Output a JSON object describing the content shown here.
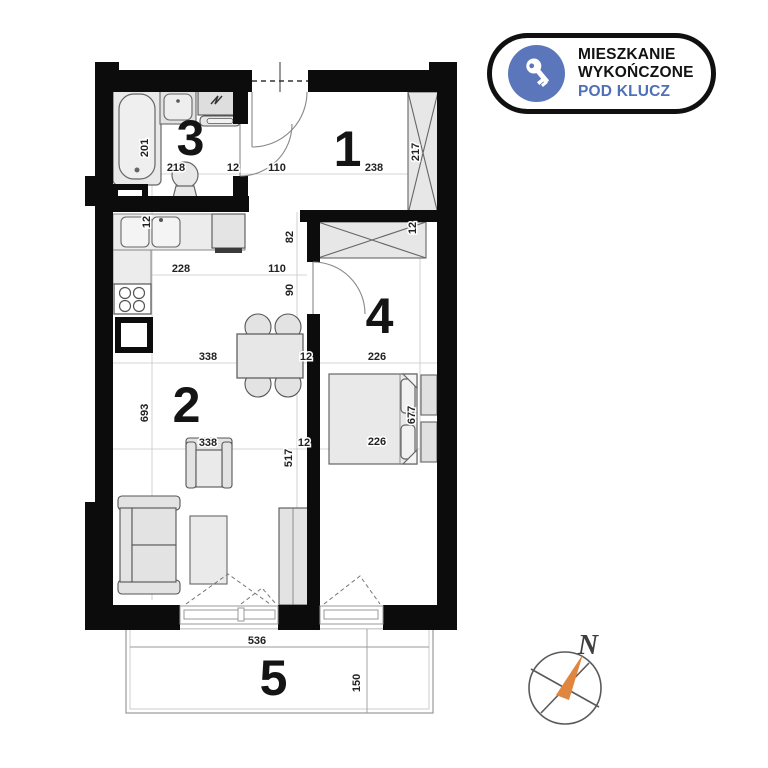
{
  "badge": {
    "line1": "MIESZKANIE",
    "line2": "WYKOŃCZONE",
    "line3": "POD KLUCZ"
  },
  "room_labels": {
    "hall": "1",
    "living": "2",
    "bath": "3",
    "bedroom": "4",
    "balcony": "5"
  },
  "dims": {
    "d12": "12",
    "d82": "82",
    "d90": "90",
    "d110": "110",
    "d150": "150",
    "d201": "201",
    "d217": "217",
    "d218": "218",
    "d226": "226",
    "d228": "228",
    "d238": "238",
    "d338": "338",
    "d517": "517",
    "d536": "536",
    "d677": "677",
    "d693": "693"
  },
  "compass": {
    "north": "N"
  },
  "colors": {
    "wall": "#0c0c0c",
    "accent_blue": "#5b76bb",
    "badge_text_blue": "#4f6fb8",
    "needle_orange": "#e0863e",
    "furniture_fill": "#e8e8e8"
  }
}
